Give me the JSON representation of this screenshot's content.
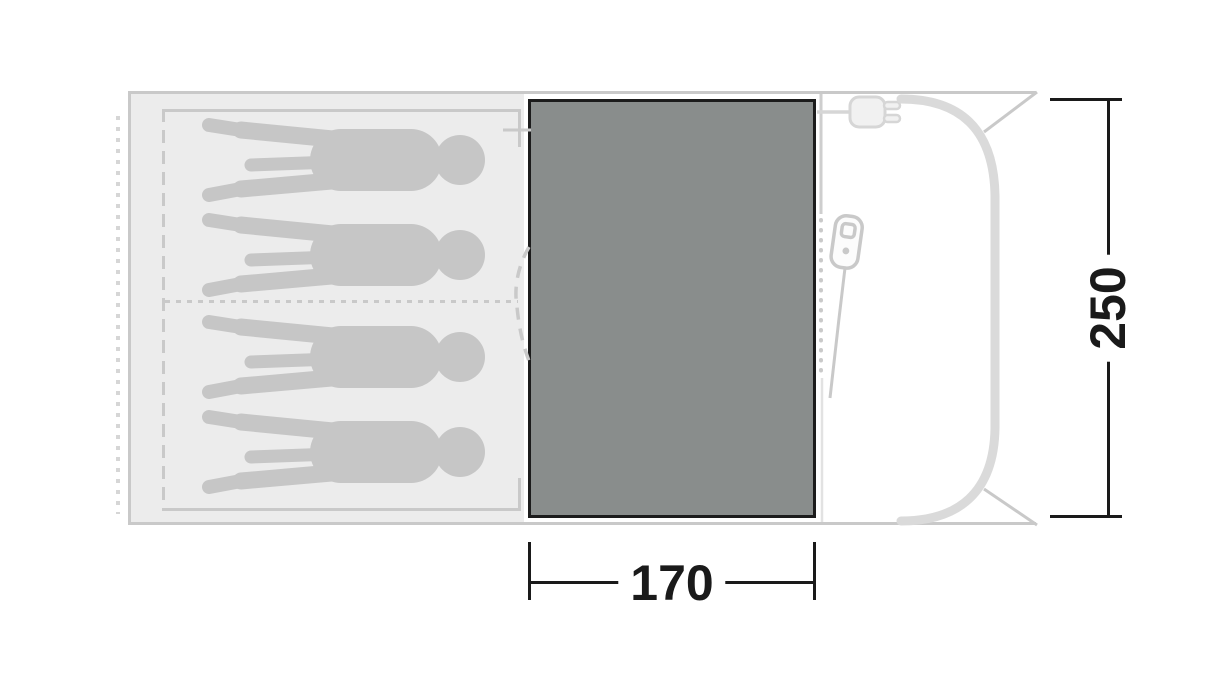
{
  "diagram": {
    "type": "tent-floorplan-top-view",
    "dimensions": {
      "width_cm": "170",
      "depth_cm": "250"
    },
    "sleeping_area": {
      "capacity": 4,
      "figure": "person-silhouette",
      "compartments": 2
    },
    "icons": {
      "power_plug": "power-plug-icon",
      "zipper_pull": "zipper-pull-icon"
    },
    "colors": {
      "background": "#ffffff",
      "floor_fill": "#ececec",
      "outline": "#c9c9c9",
      "silhouette": "#c6c6c6",
      "pole": "#dadada",
      "groundsheet": "#898d8c",
      "groundsheet_border": "#1c1c1c",
      "dimension": "#1a1a1a"
    }
  }
}
